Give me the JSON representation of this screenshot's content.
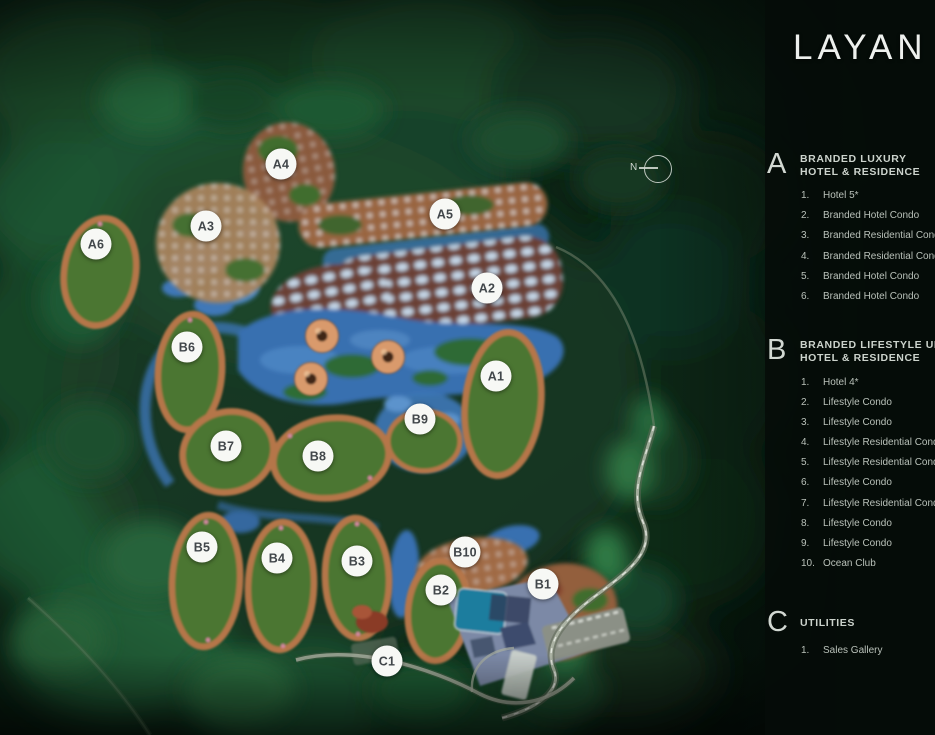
{
  "title": "LAYAN V",
  "compass": {
    "label": "N"
  },
  "map": {
    "markers": [
      {
        "label": "A4"
      },
      {
        "label": "A3"
      },
      {
        "label": "A6"
      },
      {
        "label": "A5"
      },
      {
        "label": "A2"
      },
      {
        "label": "B6"
      },
      {
        "label": "A1"
      },
      {
        "label": "B9"
      },
      {
        "label": "B7"
      },
      {
        "label": "B8"
      },
      {
        "label": "B5"
      },
      {
        "label": "B4"
      },
      {
        "label": "B3"
      },
      {
        "label": "B10"
      },
      {
        "label": "B2"
      },
      {
        "label": "B1"
      },
      {
        "label": "C1"
      }
    ]
  },
  "legend": {
    "sections": [
      {
        "letter": "A",
        "title_line1": "BRANDED LUXURY",
        "title_line2": "HOTEL & RESIDENCE",
        "items": [
          {
            "num": "1.",
            "label": "Hotel 5*"
          },
          {
            "num": "2.",
            "label": "Branded Hotel Condo"
          },
          {
            "num": "3.",
            "label": "Branded Residential Condo"
          },
          {
            "num": "4.",
            "label": "Branded Residential Condo"
          },
          {
            "num": "5.",
            "label": "Branded Hotel Condo"
          },
          {
            "num": "6.",
            "label": "Branded Hotel Condo"
          }
        ]
      },
      {
        "letter": "B",
        "title_line1": "BRANDED LIFESTYLE UPS",
        "title_line2": "HOTEL & RESIDENCE",
        "items": [
          {
            "num": "1.",
            "label": "Hotel 4*"
          },
          {
            "num": "2.",
            "label": "Lifestyle Condo"
          },
          {
            "num": "3.",
            "label": "Lifestyle Condo"
          },
          {
            "num": "4.",
            "label": "Lifestyle Residential Condo"
          },
          {
            "num": "5.",
            "label": "Lifestyle Residential Condo"
          },
          {
            "num": "6.",
            "label": "Lifestyle Condo"
          },
          {
            "num": "7.",
            "label": "Lifestyle Residential Condo"
          },
          {
            "num": "8.",
            "label": "Lifestyle Condo"
          },
          {
            "num": "9.",
            "label": "Lifestyle Condo"
          },
          {
            "num": "10.",
            "label": "Ocean Club"
          }
        ]
      },
      {
        "letter": "C",
        "title_line1": "UTILITIES",
        "title_line2": "",
        "items": [
          {
            "num": "1.",
            "label": "Sales Gallery"
          }
        ]
      }
    ]
  },
  "colors": {
    "terracotta": "#b5764a",
    "water_blue": "#3a74b4",
    "forest_green": "#143b24",
    "marker_bg": "#f7f8f5",
    "legend_text": "#c6cdc6"
  }
}
